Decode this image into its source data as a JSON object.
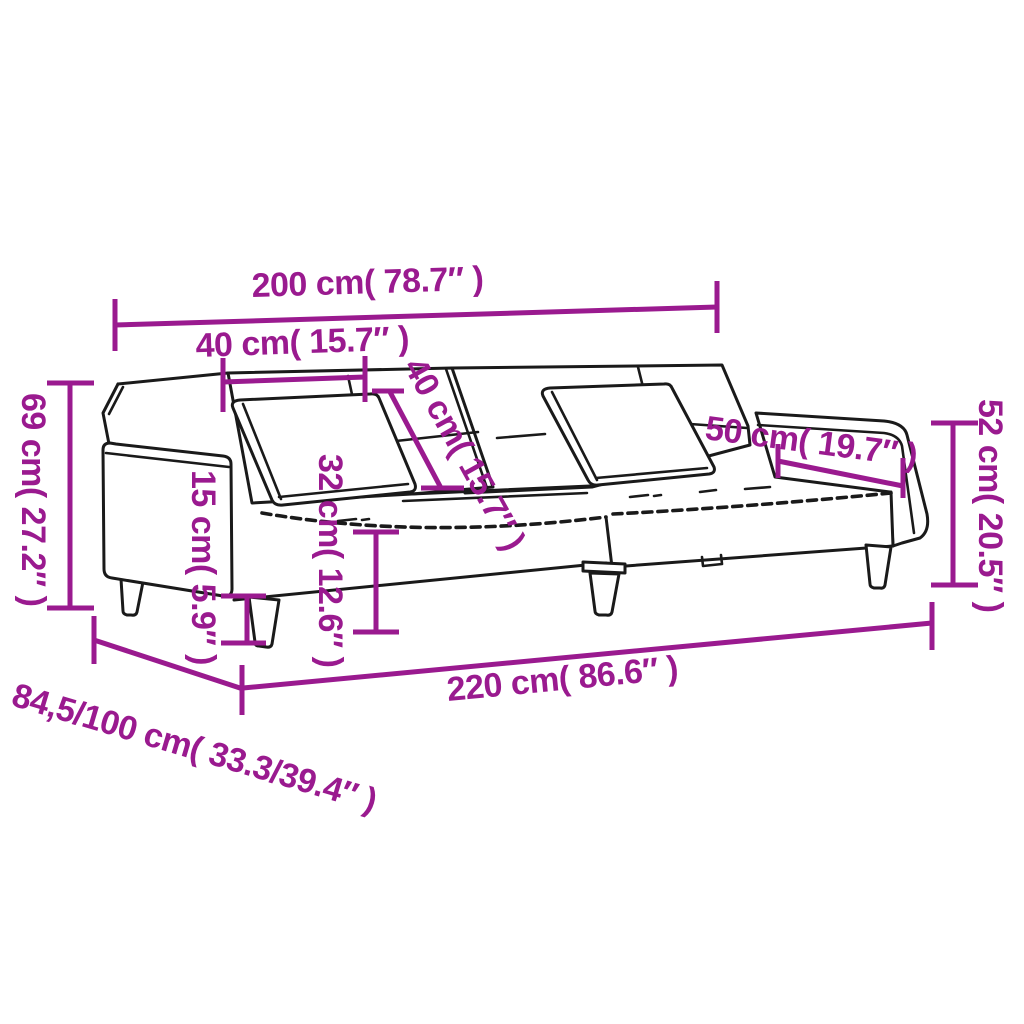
{
  "diagram": {
    "subject": "sofa-bed-with-two-pillows-dimension-drawing",
    "background_color": "#ffffff",
    "outline_color": "#1a1a1a",
    "dimension_color": "#9a1a8f"
  },
  "dimensions": {
    "top_width": "200 cm( 78.7″ )",
    "backrest_section_width": "40 cm( 15.7″ )",
    "backrest_fold_depth": "40 cm( 15.7″ )",
    "backrest_height": "69 cm( 27.2″ )",
    "leg_height": "15 cm( 5.9″ )",
    "seat_height": "32 cm( 12.6″ )",
    "armrest_top_length": "50 cm( 19.7″ )",
    "armrest_height": "52 cm( 20.5″ )",
    "total_length": "220 cm( 86.6″ )",
    "depth_range": "84,5/100 cm( 33.3/39.4″ )"
  }
}
